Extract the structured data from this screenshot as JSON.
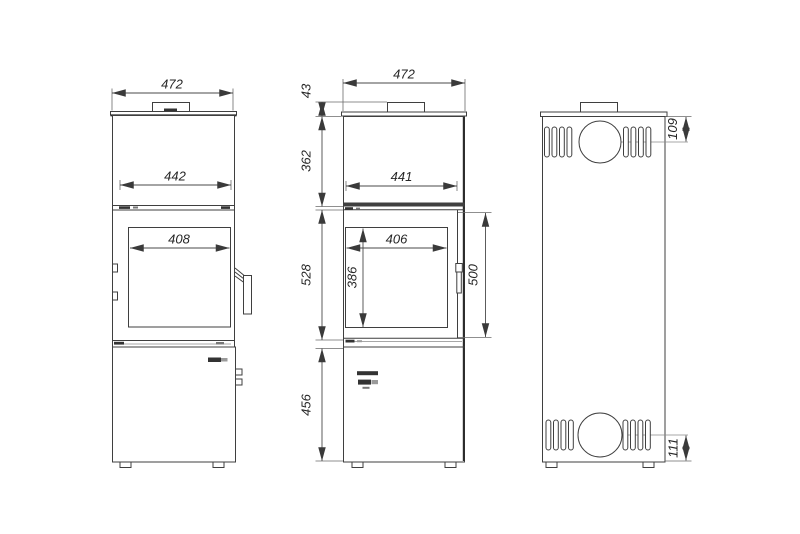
{
  "drawing_title": "stove-dimension-drawing",
  "colors": {
    "background": "#ffffff",
    "line": "#3f3f3f",
    "text": "#262626"
  },
  "views": {
    "side": {
      "name": "side-view-with-handle",
      "overall_width": "472",
      "inner_width": "442",
      "glass_width": "408"
    },
    "front": {
      "name": "front-view",
      "overall_width": "472",
      "collar_height": "43",
      "upper_section_height": "362",
      "door_width": "441",
      "glass_width": "406",
      "glass_height": "386",
      "firebox_section_height": "528",
      "door_height": "500",
      "base_section_height": "456"
    },
    "back": {
      "name": "back-view-with-flue-outlets",
      "flue_center_from_top": "109",
      "flue_center_from_bottom": "111"
    }
  }
}
